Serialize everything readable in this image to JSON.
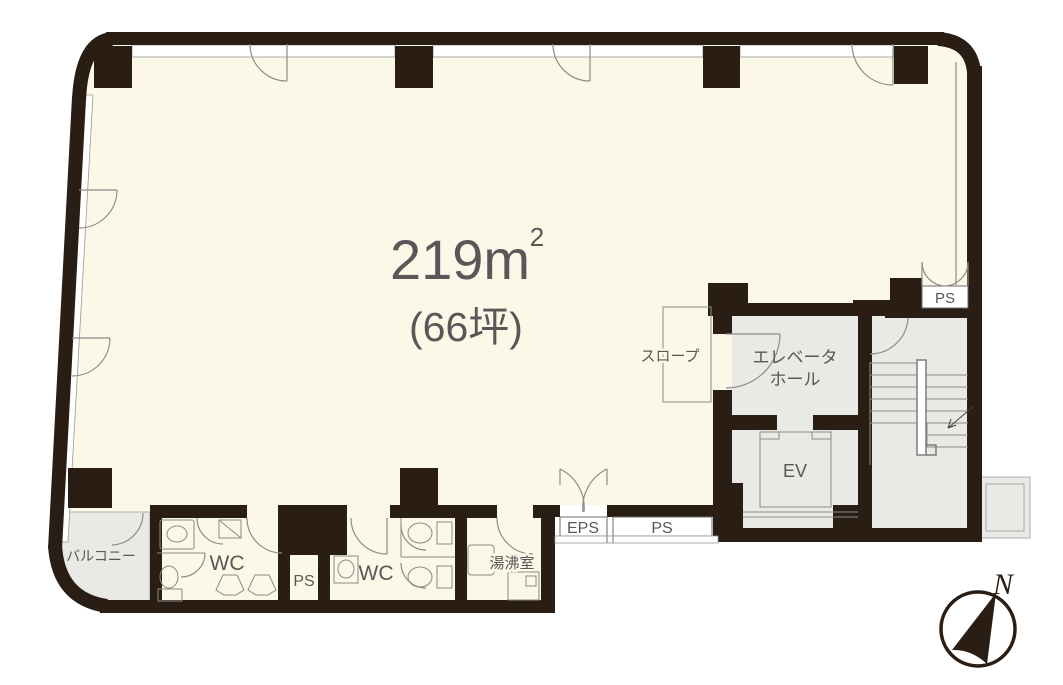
{
  "floorplan": {
    "area": {
      "value": "219m",
      "sup": "2",
      "tsubo": "(66坪)"
    },
    "labels": {
      "slope": "スロープ",
      "elevator_hall_line1": "エレベータ",
      "elevator_hall_line2": "ホール",
      "elevator": "EV",
      "ps_upper_right": "PS",
      "eps": "EPS",
      "ps_lower_center": "PS",
      "wc_left": "WC",
      "ps_restroom": "PS",
      "wc_right": "WC",
      "kitchenette": "湯沸室",
      "balcony": "バルコニー"
    },
    "compass": {
      "north": "N"
    },
    "colors": {
      "wall": "#2A1D14",
      "floor": "#FBF8E8",
      "service_area": "#E9E9E6",
      "outline": "#8C8C8A",
      "text": "#595757"
    }
  }
}
